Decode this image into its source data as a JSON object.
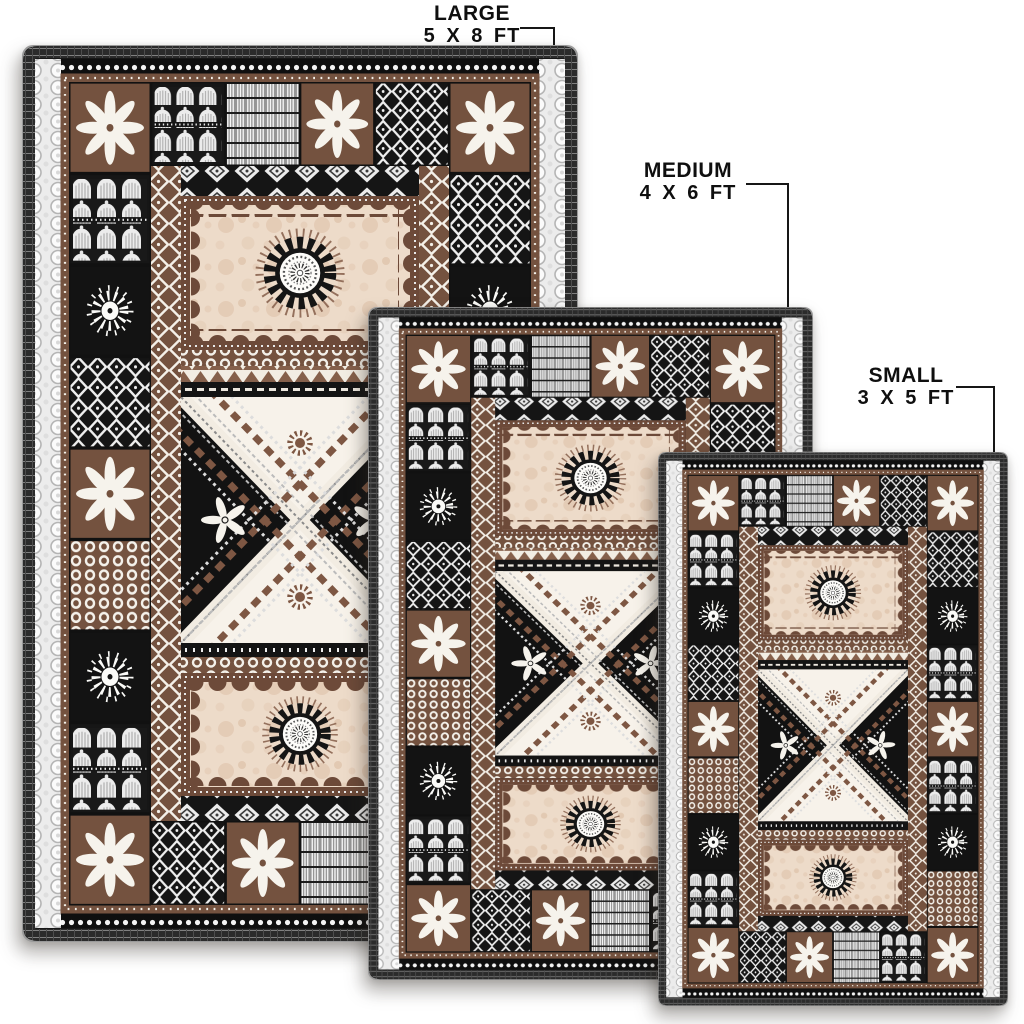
{
  "product": {
    "description": "Fijian tapa style black, brown and cream patchwork area rug shown in three sizes",
    "variants": [
      {
        "id": "large",
        "label": "LARGE",
        "dimensions": "5 X 8 FT"
      },
      {
        "id": "medium",
        "label": "MEDIUM",
        "dimensions": "4 X 6 FT"
      },
      {
        "id": "small",
        "label": "SMALL",
        "dimensions": "3 X 5 FT"
      }
    ],
    "palette": {
      "black": "#171717",
      "brown": "#74523f",
      "dark_brown": "#6d4a39",
      "cream": "#eddbc9",
      "off_white": "#f4f1ea",
      "gray": "#969696",
      "label_text": "#0f0f0f",
      "background": "#ffffff"
    }
  }
}
